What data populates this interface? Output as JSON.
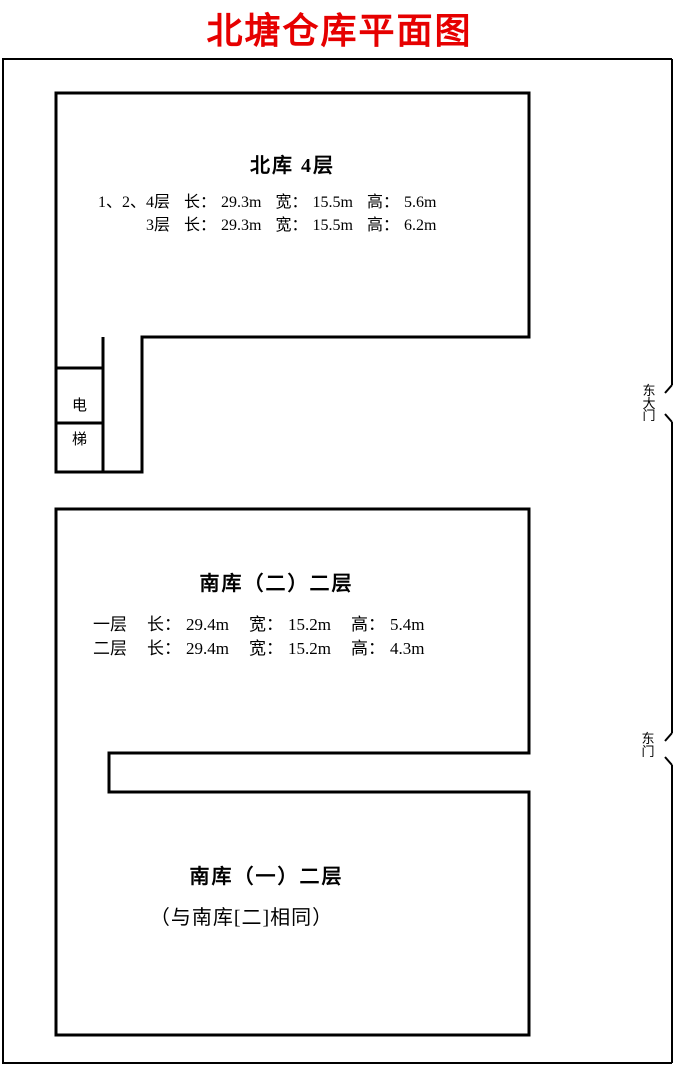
{
  "page_title": "北塘仓库平面图",
  "colors": {
    "title": "#e60000",
    "wall": "#000000"
  },
  "labels": {
    "length": "长：",
    "width": "宽：",
    "height": "高："
  },
  "north_building": {
    "title": "北库 4层",
    "rows": [
      {
        "label": "1、2、4层",
        "length": "29.3m",
        "width": "15.5m",
        "height": "5.6m"
      },
      {
        "label": "3层",
        "length": "29.3m",
        "width": "15.5m",
        "height": "6.2m"
      }
    ]
  },
  "elevator": {
    "top_char": "电",
    "bottom_char": "梯"
  },
  "gates": {
    "east_main_gate": "东大门",
    "east_gate": "东门"
  },
  "south2_building": {
    "title": "南库（二）二层",
    "rows": [
      {
        "label": "一层",
        "length": "29.4m",
        "width": "15.2m",
        "height": "5.4m"
      },
      {
        "label": "二层",
        "length": "29.4m",
        "width": "15.2m",
        "height": "4.3m"
      }
    ]
  },
  "south1_building": {
    "title": "南库（一）二层",
    "note": "（与南库[二]相同）"
  }
}
